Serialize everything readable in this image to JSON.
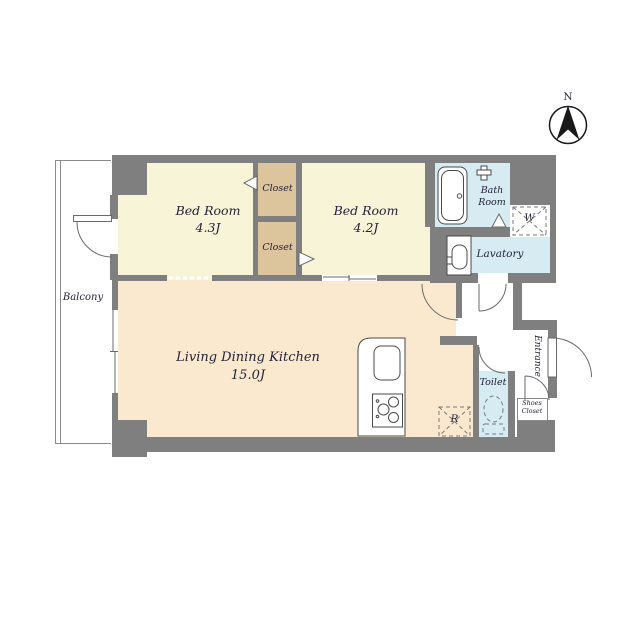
{
  "compass": {
    "north_label": "N"
  },
  "rooms": {
    "balcony": {
      "label": "Balcony"
    },
    "bedroom1": {
      "name": "Bed Room",
      "size": "4.3J"
    },
    "bedroom2": {
      "name": "Bed Room",
      "size": "4.2J"
    },
    "closet_top": {
      "label": "Closet"
    },
    "closet_bottom": {
      "label": "Closet"
    },
    "ldk": {
      "name": "Living Dining Kitchen",
      "size": "15.0J"
    },
    "bath": {
      "line1": "Bath",
      "line2": "Room"
    },
    "lavatory": {
      "label": "Lavatory"
    },
    "toilet": {
      "label": "Toilet"
    },
    "entrance": {
      "label": "Entrance"
    },
    "shoes_closet": {
      "line1": "Shoes",
      "line2": "Closet"
    }
  },
  "appliances": {
    "washer_label": "W",
    "refrigerator_label": "R"
  },
  "colors": {
    "wall": "#7f7f7f",
    "bedroom_floor": "#f8f4d7",
    "closet_floor": "#dcc49c",
    "ldk_floor": "#fae9cf",
    "wet_area_floor": "#d6ecf2",
    "outline": "#6a6a6a",
    "text": "#23233a"
  }
}
